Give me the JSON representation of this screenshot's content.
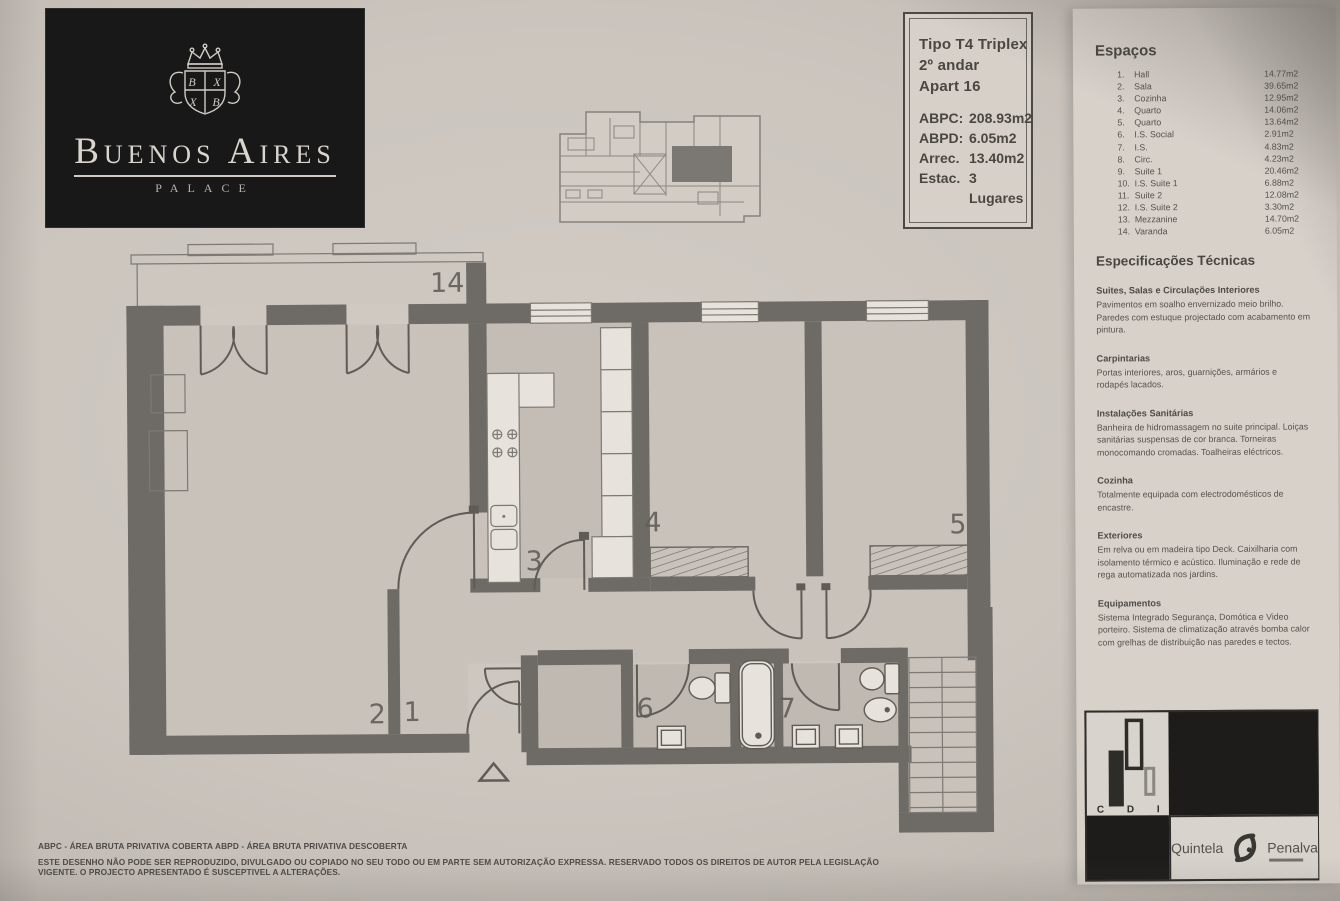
{
  "logo": {
    "name": "Buenos Aires",
    "subtitle": "PALACE"
  },
  "info_box": {
    "type_lines": [
      "Tipo T4 Triplex",
      "2º andar",
      "Apart 16"
    ],
    "specs": [
      {
        "label": "ABPC:",
        "value": "208.93m2"
      },
      {
        "label": "ABPD:",
        "value": "6.05m2"
      },
      {
        "label": "Arrec.",
        "value": "13.40m2"
      },
      {
        "label": "Estac.",
        "value": "3 Lugares"
      }
    ]
  },
  "plan": {
    "labels": {
      "varanda": "14",
      "sala": "2",
      "hall": "1",
      "cozinha": "3",
      "quarto4": "4",
      "quarto5": "5",
      "is_social": "6",
      "is": "7"
    }
  },
  "spaces": {
    "title": "Espaços",
    "items": [
      {
        "num": "1.",
        "name": "Hall",
        "area": "14.77m2"
      },
      {
        "num": "2.",
        "name": "Sala",
        "area": "39.65m2"
      },
      {
        "num": "3.",
        "name": "Cozinha",
        "area": "12.95m2"
      },
      {
        "num": "4.",
        "name": "Quarto",
        "area": "14.06m2"
      },
      {
        "num": "5.",
        "name": "Quarto",
        "area": "13.64m2"
      },
      {
        "num": "6.",
        "name": "I.S. Social",
        "area": "2.91m2"
      },
      {
        "num": "7.",
        "name": "I.S.",
        "area": "4.83m2"
      },
      {
        "num": "8.",
        "name": "Circ.",
        "area": "4.23m2"
      },
      {
        "num": "9.",
        "name": "Suite 1",
        "area": "20.46m2"
      },
      {
        "num": "10.",
        "name": "I.S. Suite 1",
        "area": "6.88m2"
      },
      {
        "num": "11.",
        "name": "Suite 2",
        "area": "12.08m2"
      },
      {
        "num": "12.",
        "name": "I.S. Suite 2",
        "area": "3.30m2"
      },
      {
        "num": "13.",
        "name": "Mezzanine",
        "area": "14.70m2"
      },
      {
        "num": "14.",
        "name": "Varanda",
        "area": "6.05m2"
      }
    ]
  },
  "tech_specs": {
    "title": "Especificações Técnicas",
    "sections": [
      {
        "heading": "Suites, Salas e Circulações Interiores",
        "body": "Pavimentos em soalho envernizado meio brilho. Paredes com estuque projectado com acabamento em pintura."
      },
      {
        "heading": "Carpintarias",
        "body": "Portas interiores, aros, guarnições, armários e rodapés lacados."
      },
      {
        "heading": "Instalações Sanitárias",
        "body": "Banheira de hidromassagem no suite principal. Loiças sanitárias suspensas de cor branca. Torneiras monocomando cromadas. Toalheiras eléctricos."
      },
      {
        "heading": "Cozinha",
        "body": "Totalmente equipada com electrodomésticos de encastre."
      },
      {
        "heading": "Exteriores",
        "body": "Em relva ou em madeira tipo Deck. Caixilharia com isolamento térmico e acústico. Iluminação e rede de rega automatizada nos jardins."
      },
      {
        "heading": "Equipamentos",
        "body": "Sistema Integrado Segurança, Domótica e Video porteiro. Sistema de climatização através bomba calor com grelhas de distribuição nas paredes e tectos."
      }
    ]
  },
  "brands": {
    "cdi": {
      "letters": [
        "C",
        "D",
        "I"
      ]
    },
    "agency": {
      "left": "Quintela",
      "right": "Penalva"
    }
  },
  "footer": {
    "abbr1": "ABPC - ÁREA BRUTA PRIVATIVA COBERTA",
    "abbr2": "ABPD - ÁREA BRUTA PRIVATIVA DESCOBERTA",
    "disclaimer": "ESTE DESENHO NÃO PODE SER REPRODUZIDO, DIVULGADO OU COPIADO NO SEU TODO OU EM PARTE SEM AUTORIZAÇÃO EXPRESSA. RESERVADO TODOS OS DIREITOS DE AUTOR PELA LEGISLAÇÃO VIGENTE. O PROJECTO APRESENTADO É SUSCEPTIVEL A ALTERAÇÕES."
  }
}
